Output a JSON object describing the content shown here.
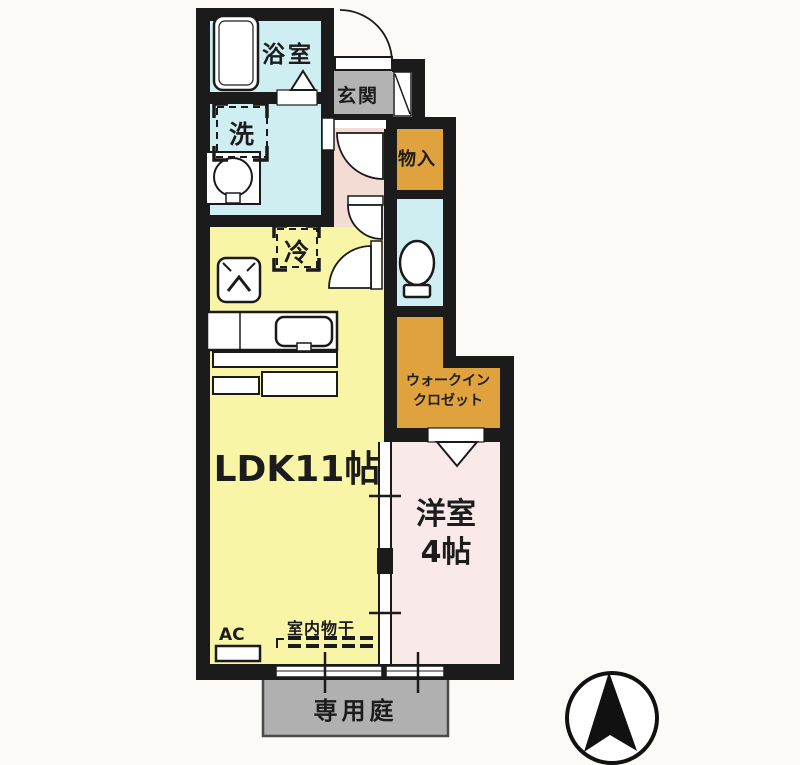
{
  "floor_plan": {
    "labels": {
      "bathroom": "浴室",
      "entrance": "玄関",
      "storage": "物入",
      "washing_machine": "洗",
      "refrigerator": "冷",
      "ldk": "LDK11帖",
      "walk_in_closet_line1": "ウォークイン",
      "walk_in_closet_line2": "クロゼット",
      "western_room_name": "洋室",
      "western_room_size": "4帖",
      "air_conditioner": "AC",
      "indoor_drying": "室内物干",
      "private_garden": "専用庭"
    },
    "colors": {
      "wall": "#1b1b1b",
      "wet_area": "#cfeef1",
      "ldk": "#f9f5a7",
      "hallway": "#f2dcd3",
      "western_room": "#f9eae9",
      "storage_orange": "#dfa23c",
      "entrance_gray": "#b3b3b3",
      "garden_gray": "#b0b0b0",
      "line": "#1a1a1a"
    },
    "icons": {
      "compass_north": "filled-north-arrow-in-circle",
      "bathtub": "rounded-rectangle-tub",
      "toilet": "bowl-with-tank",
      "washbasin": "round-basin-in-square",
      "kitchen_sink": "rounded-sink-in-counter",
      "stove": "box-with-chevron",
      "door_swing": "quarter-circle-arc",
      "folding_door": "triangle-marker"
    }
  }
}
